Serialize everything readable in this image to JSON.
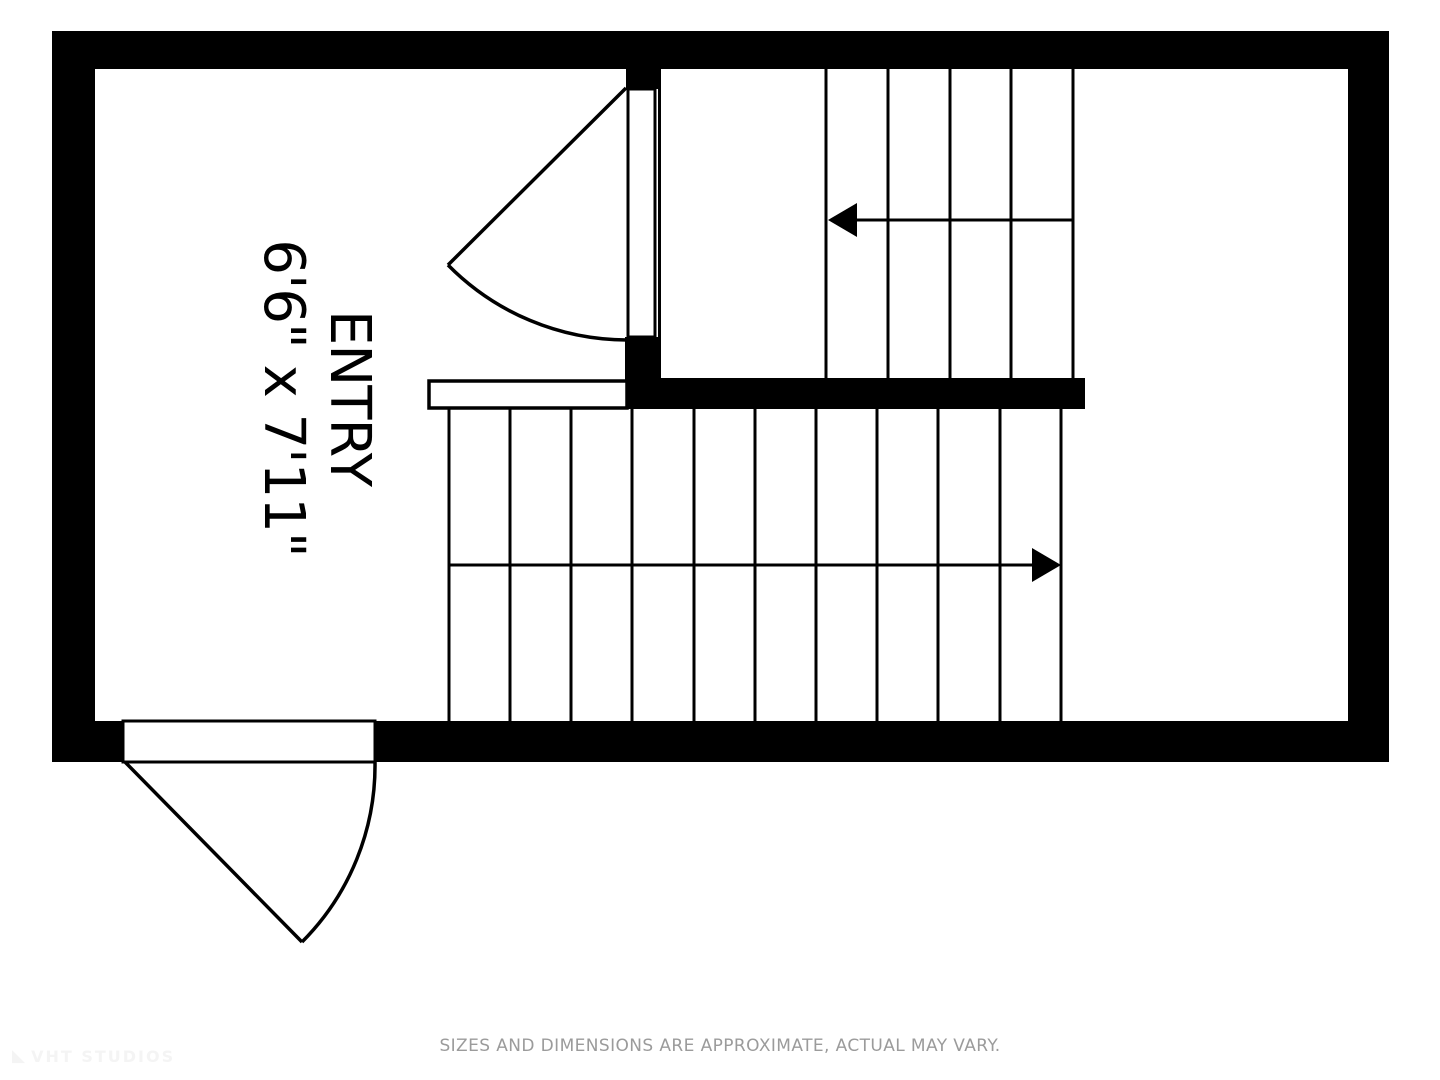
{
  "floor_plan": {
    "room": {
      "label": "ENTRY",
      "dimensions": "6'6\" x 7'11\""
    }
  },
  "footer": {
    "disclaimer": "SIZES AND DIMENSIONS ARE APPROXIMATE, ACTUAL MAY VARY."
  },
  "watermark": {
    "brand": "VHT STUDIOS"
  },
  "colors": {
    "wall": "#000000",
    "background": "#ffffff",
    "line": "#000000",
    "disclaimer_text": "#9b9b9b",
    "watermark_text": "#f4f4f4"
  }
}
